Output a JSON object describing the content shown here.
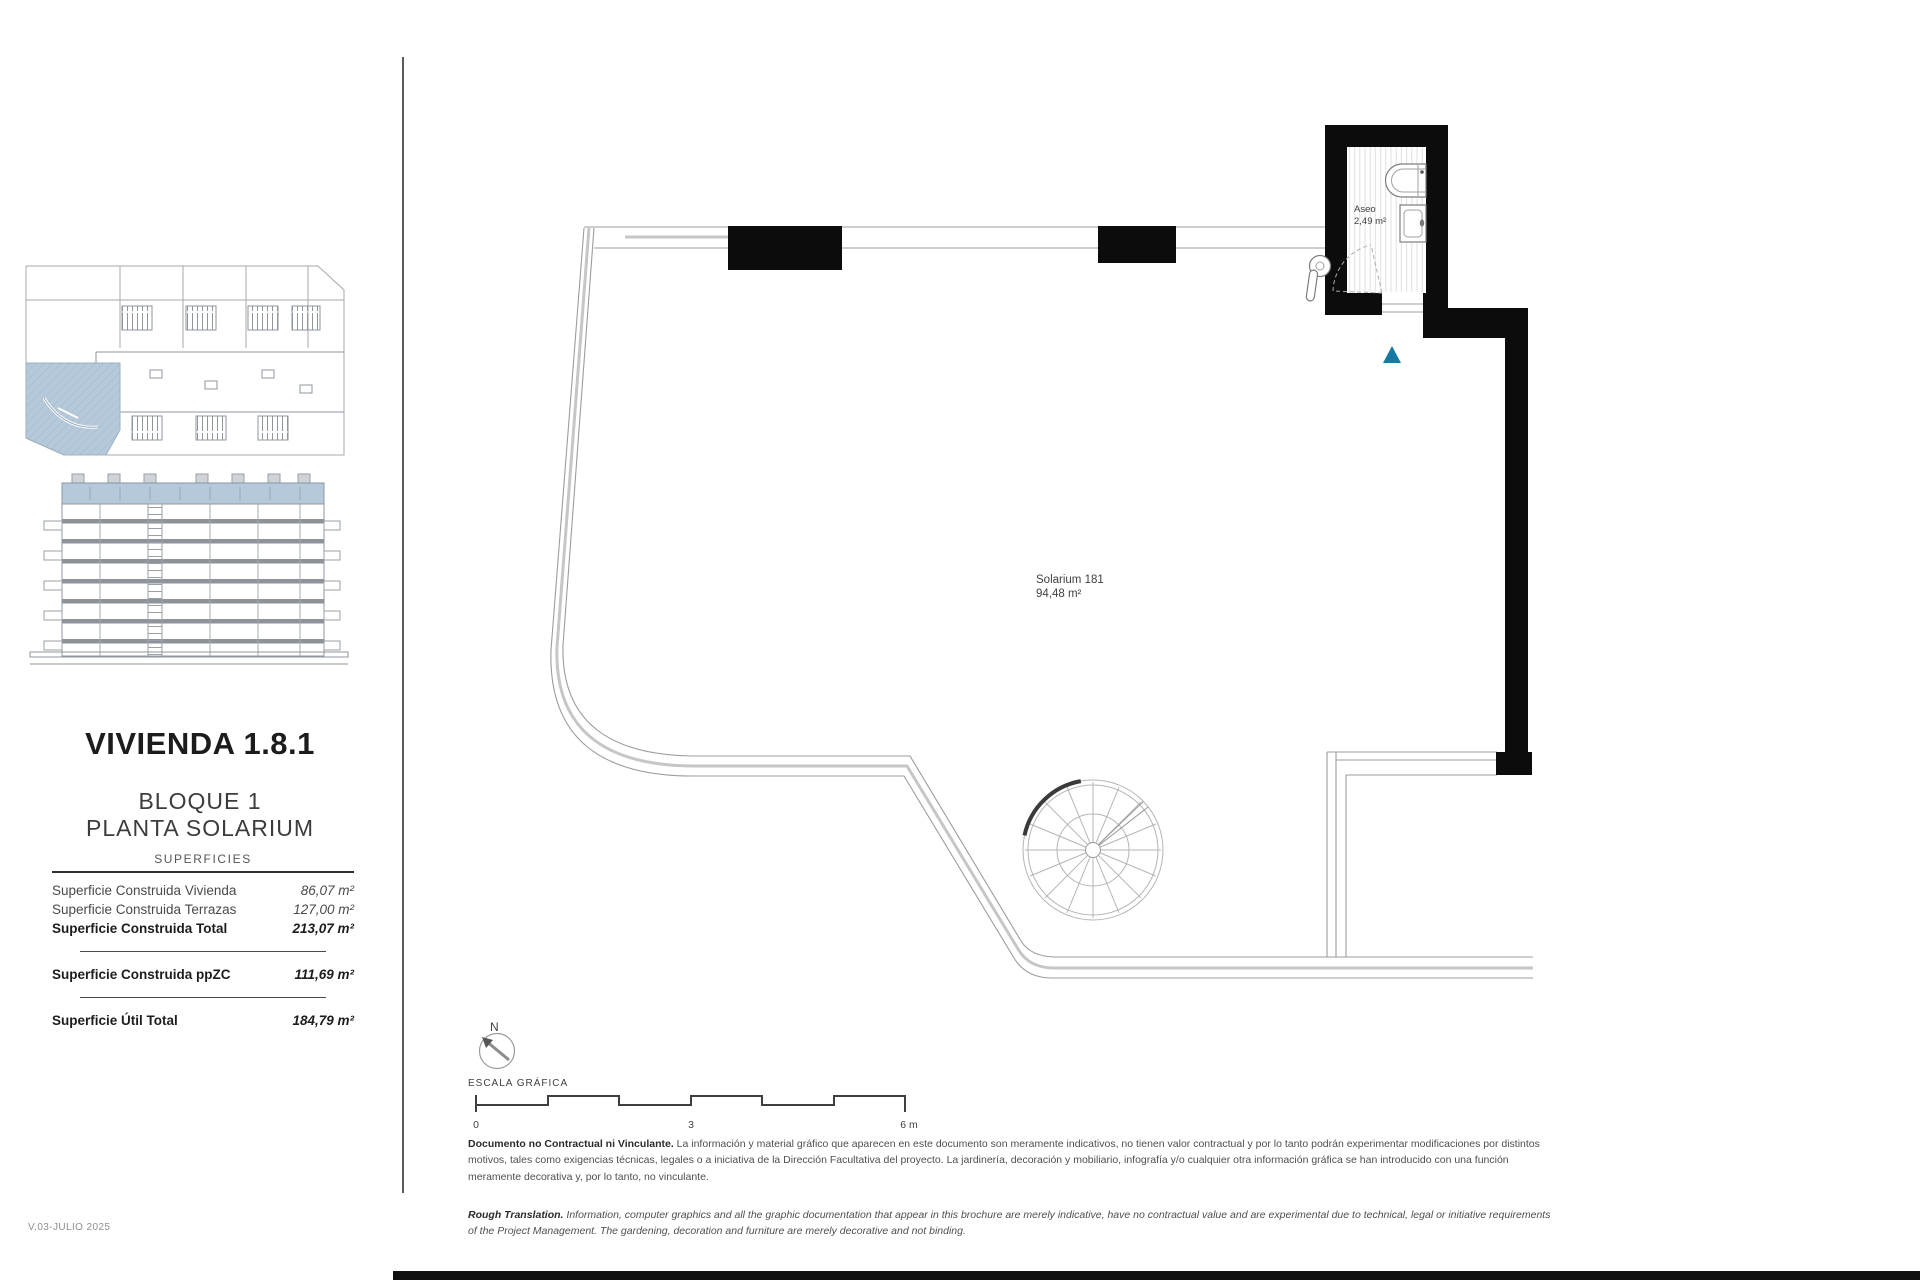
{
  "page": {
    "version_note": "V.03-JULIO 2025"
  },
  "sidebar": {
    "title": "VIVIENDA 1.8.1",
    "subtitle_line1": "BLOQUE 1",
    "subtitle_line2": "PLANTA SOLARIUM",
    "table": {
      "header": "SUPERFICIES",
      "rows": [
        {
          "label": "Superficie Construida Vivienda",
          "value": "86,07 m²"
        },
        {
          "label": "Superficie Construida Terrazas",
          "value": "127,00 m²"
        },
        {
          "label": "Superficie Construida Total",
          "value": "213,07 m²"
        },
        {
          "label": "Superficie Construida ppZC",
          "value": "111,69 m²"
        },
        {
          "label": "Superficie Útil Total",
          "value": "184,79 m²"
        }
      ]
    }
  },
  "plan": {
    "room_label_line1": "Solarium 181",
    "room_label_line2": "94,48 m²",
    "aseo_label_line1": "Aseo",
    "aseo_label_line2": "2,49 m²",
    "north_label": "N",
    "scale_label": "ESCALA GRÁFICA",
    "scale_ticks": [
      "0",
      "3",
      "6 m"
    ]
  },
  "footer": {
    "disclaimer_es_lead": "Documento no Contractual ni Vinculante.",
    "disclaimer_es": " La información y material gráfico que aparecen en este documento son meramente indicativos, no tienen valor contractual y por lo tanto podrán experimentar modificaciones por distintos motivos, tales como exigencias técnicas, legales o a iniciativa de la Dirección Facultativa del proyecto. La jardinería, decoración y mobiliario, infografía y/o cualquier otra información gráfica se han introducido con una función meramente decorativa y, por lo tanto, no vinculante.",
    "disclaimer_en_lead": "Rough Translation.",
    "disclaimer_en": " Information, computer graphics and all the graphic documentation that appear in this brochure are merely indicative, have no contractual value and are experimental due to technical, legal or initiative requirements of the Project Management. The gardening, decoration and furniture are merely decorative and not binding."
  },
  "colors": {
    "highlight_blue": "#b5c9da",
    "marker_teal": "#1878a2",
    "line_gray": "#9c9c9c",
    "text_dark": "#3f3f3f"
  }
}
